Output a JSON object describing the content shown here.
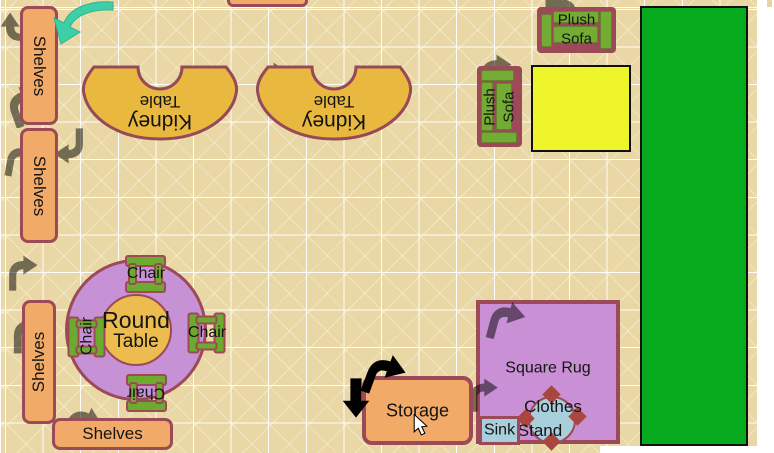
{
  "app": {
    "title": "Classroom floor plan canvas"
  },
  "colors": {
    "canvas_tan": "#e9d8a5",
    "grid_line": "#ffffff",
    "item_border_rose": "#9c4a57",
    "shelf_orange": "#f2aa69",
    "kidney_gold": "#e9b93f",
    "furniture_green": "#72ac32",
    "big_green_area": "#06ab1d",
    "yellow_mat": "#eef52a",
    "table_purple": "#c791d6",
    "table_center_gold": "#ecbc4e",
    "rug_purple": "#ca90d6",
    "water_blue": "#a9cfdd",
    "rotate_arrow_teal": "#3fcfa7"
  },
  "items": {
    "shelves_top_left": {
      "label": "Shelves"
    },
    "shelves_mid_left": {
      "label": "Shelves"
    },
    "shelves_lower_left": {
      "label": "Shelves"
    },
    "shelves_bottom": {
      "label": "Shelves"
    },
    "kidney_table_1": {
      "line1": "Kidney",
      "line2": "Table"
    },
    "kidney_table_2": {
      "line1": "Kidney",
      "line2": "Table"
    },
    "plush_sofa_top": {
      "line1": "Plush",
      "line2": "Sofa"
    },
    "plush_sofa_left": {
      "line1": "Plush",
      "line2": "Sofa"
    },
    "round_table": {
      "line1": "Round",
      "line2": "Table"
    },
    "chairs": {
      "top": {
        "label": "Chair"
      },
      "left": {
        "label": "Chair"
      },
      "right": {
        "label": "Chair"
      },
      "bottom": {
        "label": "Chair"
      }
    },
    "storage": {
      "label": "Storage"
    },
    "square_rug": {
      "label": "Square Rug"
    },
    "clothes_stand": {
      "line1": "Clothes",
      "line2": "Stand"
    },
    "sink": {
      "label": "Sink"
    }
  },
  "icons": {
    "teal_rotate_arrow": "curved rotate arrow (teal)",
    "rotate_handle_arrow": "curved rotate arrow handle",
    "move_down_arrow": "down arrow handle",
    "ghost_rotate_arrow": "faint rotate arrow watermark",
    "mouse_cursor": "pointer cursor"
  }
}
